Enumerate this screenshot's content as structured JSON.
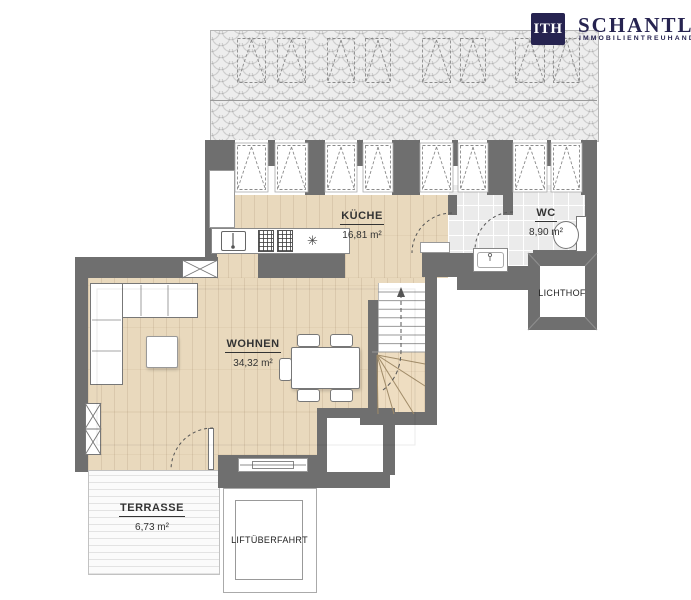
{
  "logo": {
    "mark": "ITH",
    "name": "SCHANTL",
    "subtitle": "IMMOBILIENTREUHAND",
    "brand_color": "#262350"
  },
  "rooms": {
    "kueche": {
      "name": "KÜCHE",
      "area": "16,81 m²"
    },
    "wc": {
      "name": "WC",
      "area": "8,90 m²"
    },
    "wohnen": {
      "name": "WOHNEN",
      "area": "34,32 m²"
    },
    "terrasse": {
      "name": "TERRASSE",
      "area": "6,73 m²"
    },
    "lichthof": {
      "name": "LICHTHOF"
    },
    "liftueberfahrt": {
      "name": "LIFTÜBERFAHRT"
    }
  },
  "icons": {
    "appliance_star": "✳"
  },
  "colors": {
    "wall": "#6f6f6f",
    "wood_floor": "#e9d9bd",
    "tile_floor": "#ebebeb",
    "brand_navy": "#262350"
  }
}
